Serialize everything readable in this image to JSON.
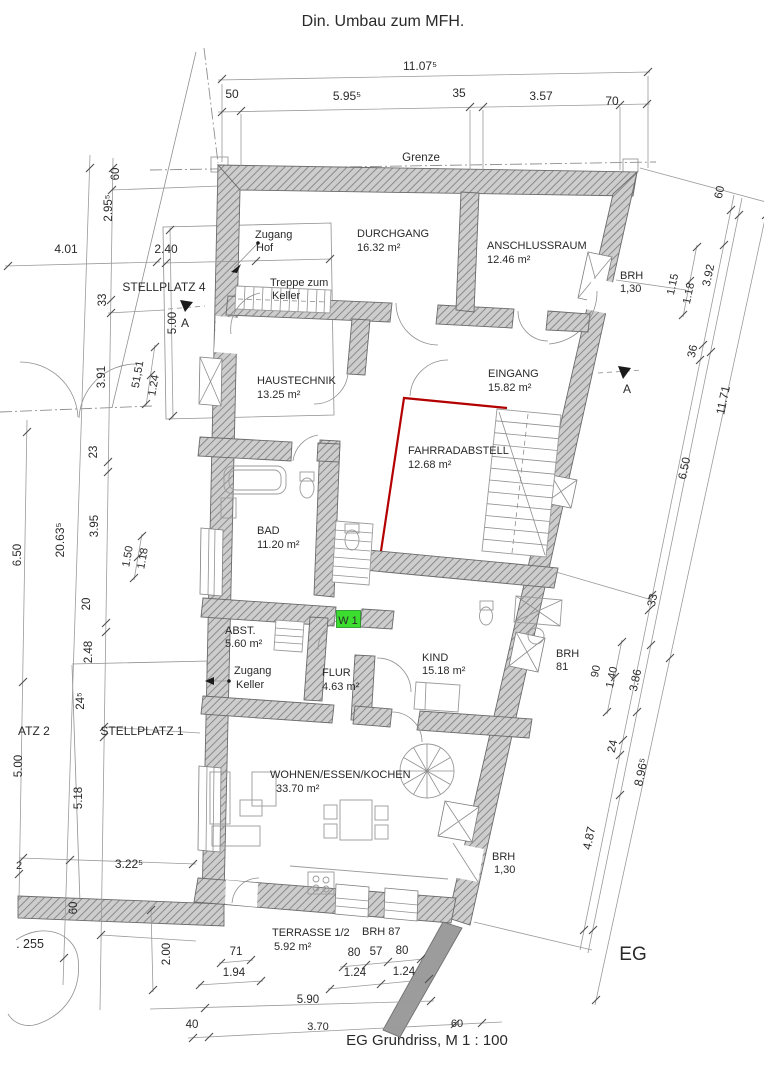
{
  "colors": {
    "wall_fill": "#cdcdcd",
    "wall_hatch": "#8a8a8a",
    "red_accent": "#b30000",
    "green_marker": "#3bdd2e",
    "line": "#8f8f8f",
    "text": "#2a2a2a"
  },
  "rooms": [
    {
      "name": "DURCHGANG",
      "area": "16.32 m²"
    },
    {
      "name": "ANSCHLUSSRAUM",
      "area": "12.46 m²"
    },
    {
      "name": "HAUSTECHNIK",
      "area": "13.25 m²"
    },
    {
      "name": "EINGANG",
      "area": "15.82 m²"
    },
    {
      "name": "FAHRRADABSTELL",
      "area": "12.68 m²"
    },
    {
      "name": "BAD",
      "area": "11.20 m²"
    },
    {
      "name": "ABST.",
      "area": "5.60 m²"
    },
    {
      "name": "FLUR",
      "area": "4.63 m²"
    },
    {
      "name": "KIND",
      "area": "15.18 m²"
    },
    {
      "name": "WOHNEN/ESSEN/KOCHEN",
      "area": "33.70 m²"
    },
    {
      "name": "TERRASSE 1/2",
      "area": "5.92 m²"
    }
  ],
  "texts": [
    {
      "name": "title",
      "t": "Din. Umbau zum MFH.",
      "x": 383,
      "y": 26,
      "s": 16
    },
    {
      "name": "dim-top-total",
      "t": "11.07⁵",
      "x": 420,
      "y": 70,
      "s": 12
    },
    {
      "name": "dim-top-50",
      "t": "50",
      "x": 232,
      "y": 98,
      "s": 12
    },
    {
      "name": "dim-top-595",
      "t": "5.95⁵",
      "x": 347,
      "y": 100,
      "s": 12
    },
    {
      "name": "dim-top-35",
      "t": "35",
      "x": 459,
      "y": 97,
      "s": 12
    },
    {
      "name": "dim-top-357",
      "t": "3.57",
      "x": 541,
      "y": 100,
      "s": 12
    },
    {
      "name": "dim-top-70",
      "t": "70",
      "x": 612,
      "y": 105,
      "s": 12
    },
    {
      "name": "grenze-label",
      "t": "Grenze",
      "x": 421,
      "y": 161,
      "s": 11.5
    },
    {
      "name": "dim-left-60-top",
      "t": "60",
      "x": 119,
      "y": 174,
      "r": -90,
      "s": 11.5
    },
    {
      "name": "dim-left-295",
      "t": "2.95⁵",
      "x": 112,
      "y": 208,
      "r": -90,
      "s": 11.5
    },
    {
      "name": "dim-left-401",
      "t": "4.01",
      "x": 66,
      "y": 253,
      "s": 12
    },
    {
      "name": "dim-left-240",
      "t": "2.40",
      "x": 166,
      "y": 253,
      "s": 12
    },
    {
      "name": "stellplatz4-label",
      "t": "STELLPLATZ 4",
      "x": 164,
      "y": 291,
      "s": 12
    },
    {
      "name": "dim-left-33",
      "t": "33",
      "x": 106,
      "y": 300,
      "r": -90,
      "s": 11.5
    },
    {
      "name": "dim-left-500a",
      "t": "5.00",
      "x": 176,
      "y": 323,
      "r": -90,
      "s": 11.5
    },
    {
      "name": "section-a-top-label",
      "t": "A",
      "x": 185,
      "y": 327,
      "s": 12
    },
    {
      "name": "dim-left-391",
      "t": "3.91",
      "x": 105,
      "y": 377,
      "r": -90,
      "s": 11.5
    },
    {
      "name": "dim-left-5151",
      "t": "51,51",
      "x": 141,
      "y": 375,
      "r": -80,
      "s": 11
    },
    {
      "name": "dim-left-124",
      "t": "1.24",
      "x": 157,
      "y": 386,
      "r": -80,
      "s": 11
    },
    {
      "name": "dim-left-23",
      "t": "23",
      "x": 97,
      "y": 452,
      "r": -90,
      "s": 11.5
    },
    {
      "name": "dim-left-2063",
      "t": "20.63⁵",
      "x": 64,
      "y": 540,
      "r": -90,
      "s": 12
    },
    {
      "name": "dim-left-395",
      "t": "3.95",
      "x": 98,
      "y": 526,
      "r": -90,
      "s": 11.5
    },
    {
      "name": "dim-left-650",
      "t": "6.50",
      "x": 21,
      "y": 555,
      "r": -90,
      "s": 11.5
    },
    {
      "name": "dim-left-150",
      "t": "1.50",
      "x": 131,
      "y": 557,
      "r": -80,
      "s": 11
    },
    {
      "name": "dim-left-118",
      "t": "1.18",
      "x": 146,
      "y": 559,
      "r": -80,
      "s": 11
    },
    {
      "name": "dim-left-20",
      "t": "20",
      "x": 90,
      "y": 604,
      "r": -90,
      "s": 11.5
    },
    {
      "name": "dim-left-248",
      "t": "2.48",
      "x": 92,
      "y": 652,
      "r": -90,
      "s": 11.5
    },
    {
      "name": "dim-left-245",
      "t": "24⁵",
      "x": 84,
      "y": 701,
      "r": -90,
      "s": 11.5
    },
    {
      "name": "stellplatz2-label",
      "t": "ATZ 2",
      "x": 18,
      "y": 735,
      "a": "start",
      "s": 12
    },
    {
      "name": "dim-left-500b",
      "t": "5.00",
      "x": 22,
      "y": 766,
      "r": -90,
      "s": 11.5
    },
    {
      "name": "stellplatz1-label",
      "t": "STELLPLATZ 1",
      "x": 142,
      "y": 735,
      "s": 12
    },
    {
      "name": "dim-left-518",
      "t": "5.18",
      "x": 82,
      "y": 798,
      "r": -90,
      "s": 11.5
    },
    {
      "name": "dim-left-3225",
      "t": "3.22⁵",
      "x": 129,
      "y": 868,
      "s": 12
    },
    {
      "name": "dim-left-2",
      "t": "2",
      "x": 19,
      "y": 869,
      "s": 11
    },
    {
      "name": "dim-wall-60",
      "t": "60",
      "x": 77,
      "y": 908,
      "r": -90,
      "s": 11.5
    },
    {
      "name": "parcel-label",
      "t": ". 255",
      "x": 30,
      "y": 948,
      "s": 12.5
    },
    {
      "name": "dim-bottom-200",
      "t": "2.00",
      "x": 170,
      "y": 954,
      "r": -90,
      "s": 11.5
    },
    {
      "name": "dim-bottom-40",
      "t": "40",
      "x": 192,
      "y": 1028,
      "s": 11.5
    },
    {
      "name": "dim-bottom-71",
      "t": "71",
      "x": 236,
      "y": 955,
      "s": 11.5
    },
    {
      "name": "dim-bottom-194",
      "t": "1.94",
      "x": 234,
      "y": 976,
      "s": 11.5
    },
    {
      "name": "dim-bottom-80a",
      "t": "80",
      "x": 354,
      "y": 956,
      "s": 11.5
    },
    {
      "name": "dim-bottom-57",
      "t": "57",
      "x": 376,
      "y": 955,
      "s": 11.5
    },
    {
      "name": "dim-bottom-80b",
      "t": "80",
      "x": 402,
      "y": 954,
      "s": 11.5
    },
    {
      "name": "dim-bottom-124a",
      "t": "1.24",
      "x": 355,
      "y": 976,
      "s": 11.5
    },
    {
      "name": "dim-bottom-124b",
      "t": "1.24",
      "x": 404,
      "y": 975,
      "s": 11.5
    },
    {
      "name": "dim-bottom-590",
      "t": "5.90",
      "x": 308,
      "y": 1003,
      "s": 11.5
    },
    {
      "name": "dim-bottom-370",
      "t": "3.70",
      "x": 318,
      "y": 1030,
      "s": 11,
      "c": "#8d8d8d"
    },
    {
      "name": "dim-bottom-60",
      "t": "60",
      "x": 457,
      "y": 1027,
      "s": 11,
      "c": "#8d8d8d"
    },
    {
      "name": "caption",
      "t": "EG Grundriss,  M 1 : 100",
      "x": 427,
      "y": 1045,
      "s": 15
    },
    {
      "name": "level-label",
      "t": "EG",
      "x": 633,
      "y": 960,
      "s": 19
    },
    {
      "name": "terrasse-label",
      "t": "TERRASSE 1/2",
      "x": 272,
      "y": 936,
      "a": "start",
      "s": 11
    },
    {
      "name": "terrasse-area",
      "t": "5.92 m²",
      "x": 274,
      "y": 950,
      "a": "start",
      "s": 11
    },
    {
      "name": "brh87-label",
      "t": "BRH 87",
      "x": 362,
      "y": 935,
      "a": "start",
      "s": 11
    },
    {
      "name": "zugang-hof-1",
      "t": "Zugang",
      "x": 255,
      "y": 238,
      "a": "start",
      "s": 11
    },
    {
      "name": "zugang-hof-2",
      "t": "Hof",
      "x": 256,
      "y": 251,
      "a": "start",
      "s": 11
    },
    {
      "name": "durchgang-label",
      "t": "DURCHGANG",
      "x": 357,
      "y": 237,
      "a": "start",
      "s": 11
    },
    {
      "name": "durchgang-area",
      "t": "16.32 m²",
      "x": 357,
      "y": 251,
      "a": "start",
      "s": 11
    },
    {
      "name": "anschlussraum-label",
      "t": "ANSCHLUSSRAUM",
      "x": 487,
      "y": 249,
      "a": "start",
      "s": 11
    },
    {
      "name": "anschlussraum-area",
      "t": "12.46 m²",
      "x": 487,
      "y": 263,
      "a": "start",
      "s": 11
    },
    {
      "name": "treppe-keller-1",
      "t": "Treppe zum",
      "x": 270,
      "y": 286,
      "a": "start",
      "s": 11
    },
    {
      "name": "treppe-keller-2",
      "t": "Keller",
      "x": 272,
      "y": 299,
      "a": "start",
      "s": 11
    },
    {
      "name": "brh130a-1",
      "t": "BRH",
      "x": 620,
      "y": 279,
      "a": "start",
      "s": 11
    },
    {
      "name": "brh130a-2",
      "t": "1,30",
      "x": 620,
      "y": 292,
      "a": "start",
      "s": 11
    },
    {
      "name": "haustechnik-label",
      "t": "HAUSTECHNIK",
      "x": 257,
      "y": 384,
      "a": "start",
      "s": 11
    },
    {
      "name": "haustechnik-area",
      "t": "13.25 m²",
      "x": 257,
      "y": 398,
      "a": "start",
      "s": 11
    },
    {
      "name": "eingang-label",
      "t": "EINGANG",
      "x": 488,
      "y": 377,
      "a": "start",
      "s": 11
    },
    {
      "name": "eingang-area",
      "t": "15.82 m²",
      "x": 488,
      "y": 391,
      "a": "start",
      "s": 11
    },
    {
      "name": "section-a-right-label",
      "t": "A",
      "x": 627,
      "y": 393,
      "s": 12
    },
    {
      "name": "fahrrad-label",
      "t": "FAHRRADABSTELL",
      "x": 408,
      "y": 454,
      "a": "start",
      "s": 11
    },
    {
      "name": "fahrrad-area",
      "t": "12.68 m²",
      "x": 408,
      "y": 468,
      "a": "start",
      "s": 11
    },
    {
      "name": "bad-label",
      "t": "BAD",
      "x": 257,
      "y": 534,
      "a": "start",
      "s": 11
    },
    {
      "name": "bad-area",
      "t": "11.20 m²",
      "x": 257,
      "y": 548,
      "a": "start",
      "s": 11
    },
    {
      "name": "w1-label",
      "t": "W 1",
      "x": 348,
      "y": 624,
      "s": 11
    },
    {
      "name": "abst-label",
      "t": "ABST.",
      "x": 225,
      "y": 634,
      "a": "start",
      "s": 11
    },
    {
      "name": "abst-area",
      "t": "5.60 m²",
      "x": 225,
      "y": 647,
      "a": "start",
      "s": 11
    },
    {
      "name": "zugang-keller-1",
      "t": "Zugang",
      "x": 234,
      "y": 674,
      "a": "start",
      "s": 11
    },
    {
      "name": "zugang-keller-2",
      "t": "Keller",
      "x": 236,
      "y": 688,
      "a": "start",
      "s": 11
    },
    {
      "name": "flur-label",
      "t": "FLUR",
      "x": 322,
      "y": 676,
      "a": "start",
      "s": 11
    },
    {
      "name": "flur-area",
      "t": "4.63 m²",
      "x": 322,
      "y": 690,
      "a": "start",
      "s": 11
    },
    {
      "name": "kind-label",
      "t": "KIND",
      "x": 422,
      "y": 661,
      "a": "start",
      "s": 11
    },
    {
      "name": "kind-area",
      "t": "15.18 m²",
      "x": 422,
      "y": 674,
      "a": "start",
      "s": 11
    },
    {
      "name": "brh81-1",
      "t": "BRH",
      "x": 556,
      "y": 657,
      "a": "start",
      "s": 11
    },
    {
      "name": "brh81-2",
      "t": "81",
      "x": 556,
      "y": 670,
      "a": "start",
      "s": 11
    },
    {
      "name": "wohnen-label",
      "t": "WOHNEN/ESSEN/KOCHEN",
      "x": 270,
      "y": 778,
      "a": "start",
      "s": 11
    },
    {
      "name": "wohnen-area",
      "t": "33.70 m²",
      "x": 276,
      "y": 792,
      "a": "start",
      "s": 11
    },
    {
      "name": "brh130b-1",
      "t": "BRH",
      "x": 492,
      "y": 860,
      "a": "start",
      "s": 11
    },
    {
      "name": "brh130b-2",
      "t": "1,30",
      "x": 494,
      "y": 873,
      "a": "start",
      "s": 11
    },
    {
      "name": "dim-right-60",
      "t": "60",
      "x": 723,
      "y": 193,
      "r": -78,
      "s": 11.5
    },
    {
      "name": "dim-right-392",
      "t": "3.92",
      "x": 712,
      "y": 276,
      "r": -78,
      "s": 11.5
    },
    {
      "name": "dim-right-115",
      "t": "1.15",
      "x": 676,
      "y": 285,
      "r": -78,
      "s": 11
    },
    {
      "name": "dim-right-118",
      "t": "1.18",
      "x": 692,
      "y": 294,
      "r": -78,
      "s": 11
    },
    {
      "name": "dim-right-36",
      "t": "36",
      "x": 696,
      "y": 352,
      "r": -78,
      "s": 11.5
    },
    {
      "name": "dim-right-1171",
      "t": "11.71",
      "x": 727,
      "y": 401,
      "r": -78,
      "s": 12
    },
    {
      "name": "dim-right-650",
      "t": "6.50",
      "x": 688,
      "y": 469,
      "r": -78,
      "s": 11.5
    },
    {
      "name": "dim-right-33",
      "t": "33",
      "x": 656,
      "y": 601,
      "r": -78,
      "s": 11.5
    },
    {
      "name": "dim-right-90",
      "t": "90",
      "x": 599,
      "y": 672,
      "r": -78,
      "s": 11
    },
    {
      "name": "dim-right-140",
      "t": "1.40",
      "x": 615,
      "y": 678,
      "r": -78,
      "s": 11
    },
    {
      "name": "dim-right-386",
      "t": "3.86",
      "x": 639,
      "y": 681,
      "r": -78,
      "s": 11.5
    },
    {
      "name": "dim-right-24",
      "t": "24",
      "x": 616,
      "y": 747,
      "r": -78,
      "s": 11.5
    },
    {
      "name": "dim-right-8965",
      "t": "8.96⁵",
      "x": 645,
      "y": 773,
      "r": -78,
      "s": 12
    },
    {
      "name": "dim-right-487",
      "t": "4.87",
      "x": 593,
      "y": 839,
      "r": -78,
      "s": 12
    }
  ]
}
